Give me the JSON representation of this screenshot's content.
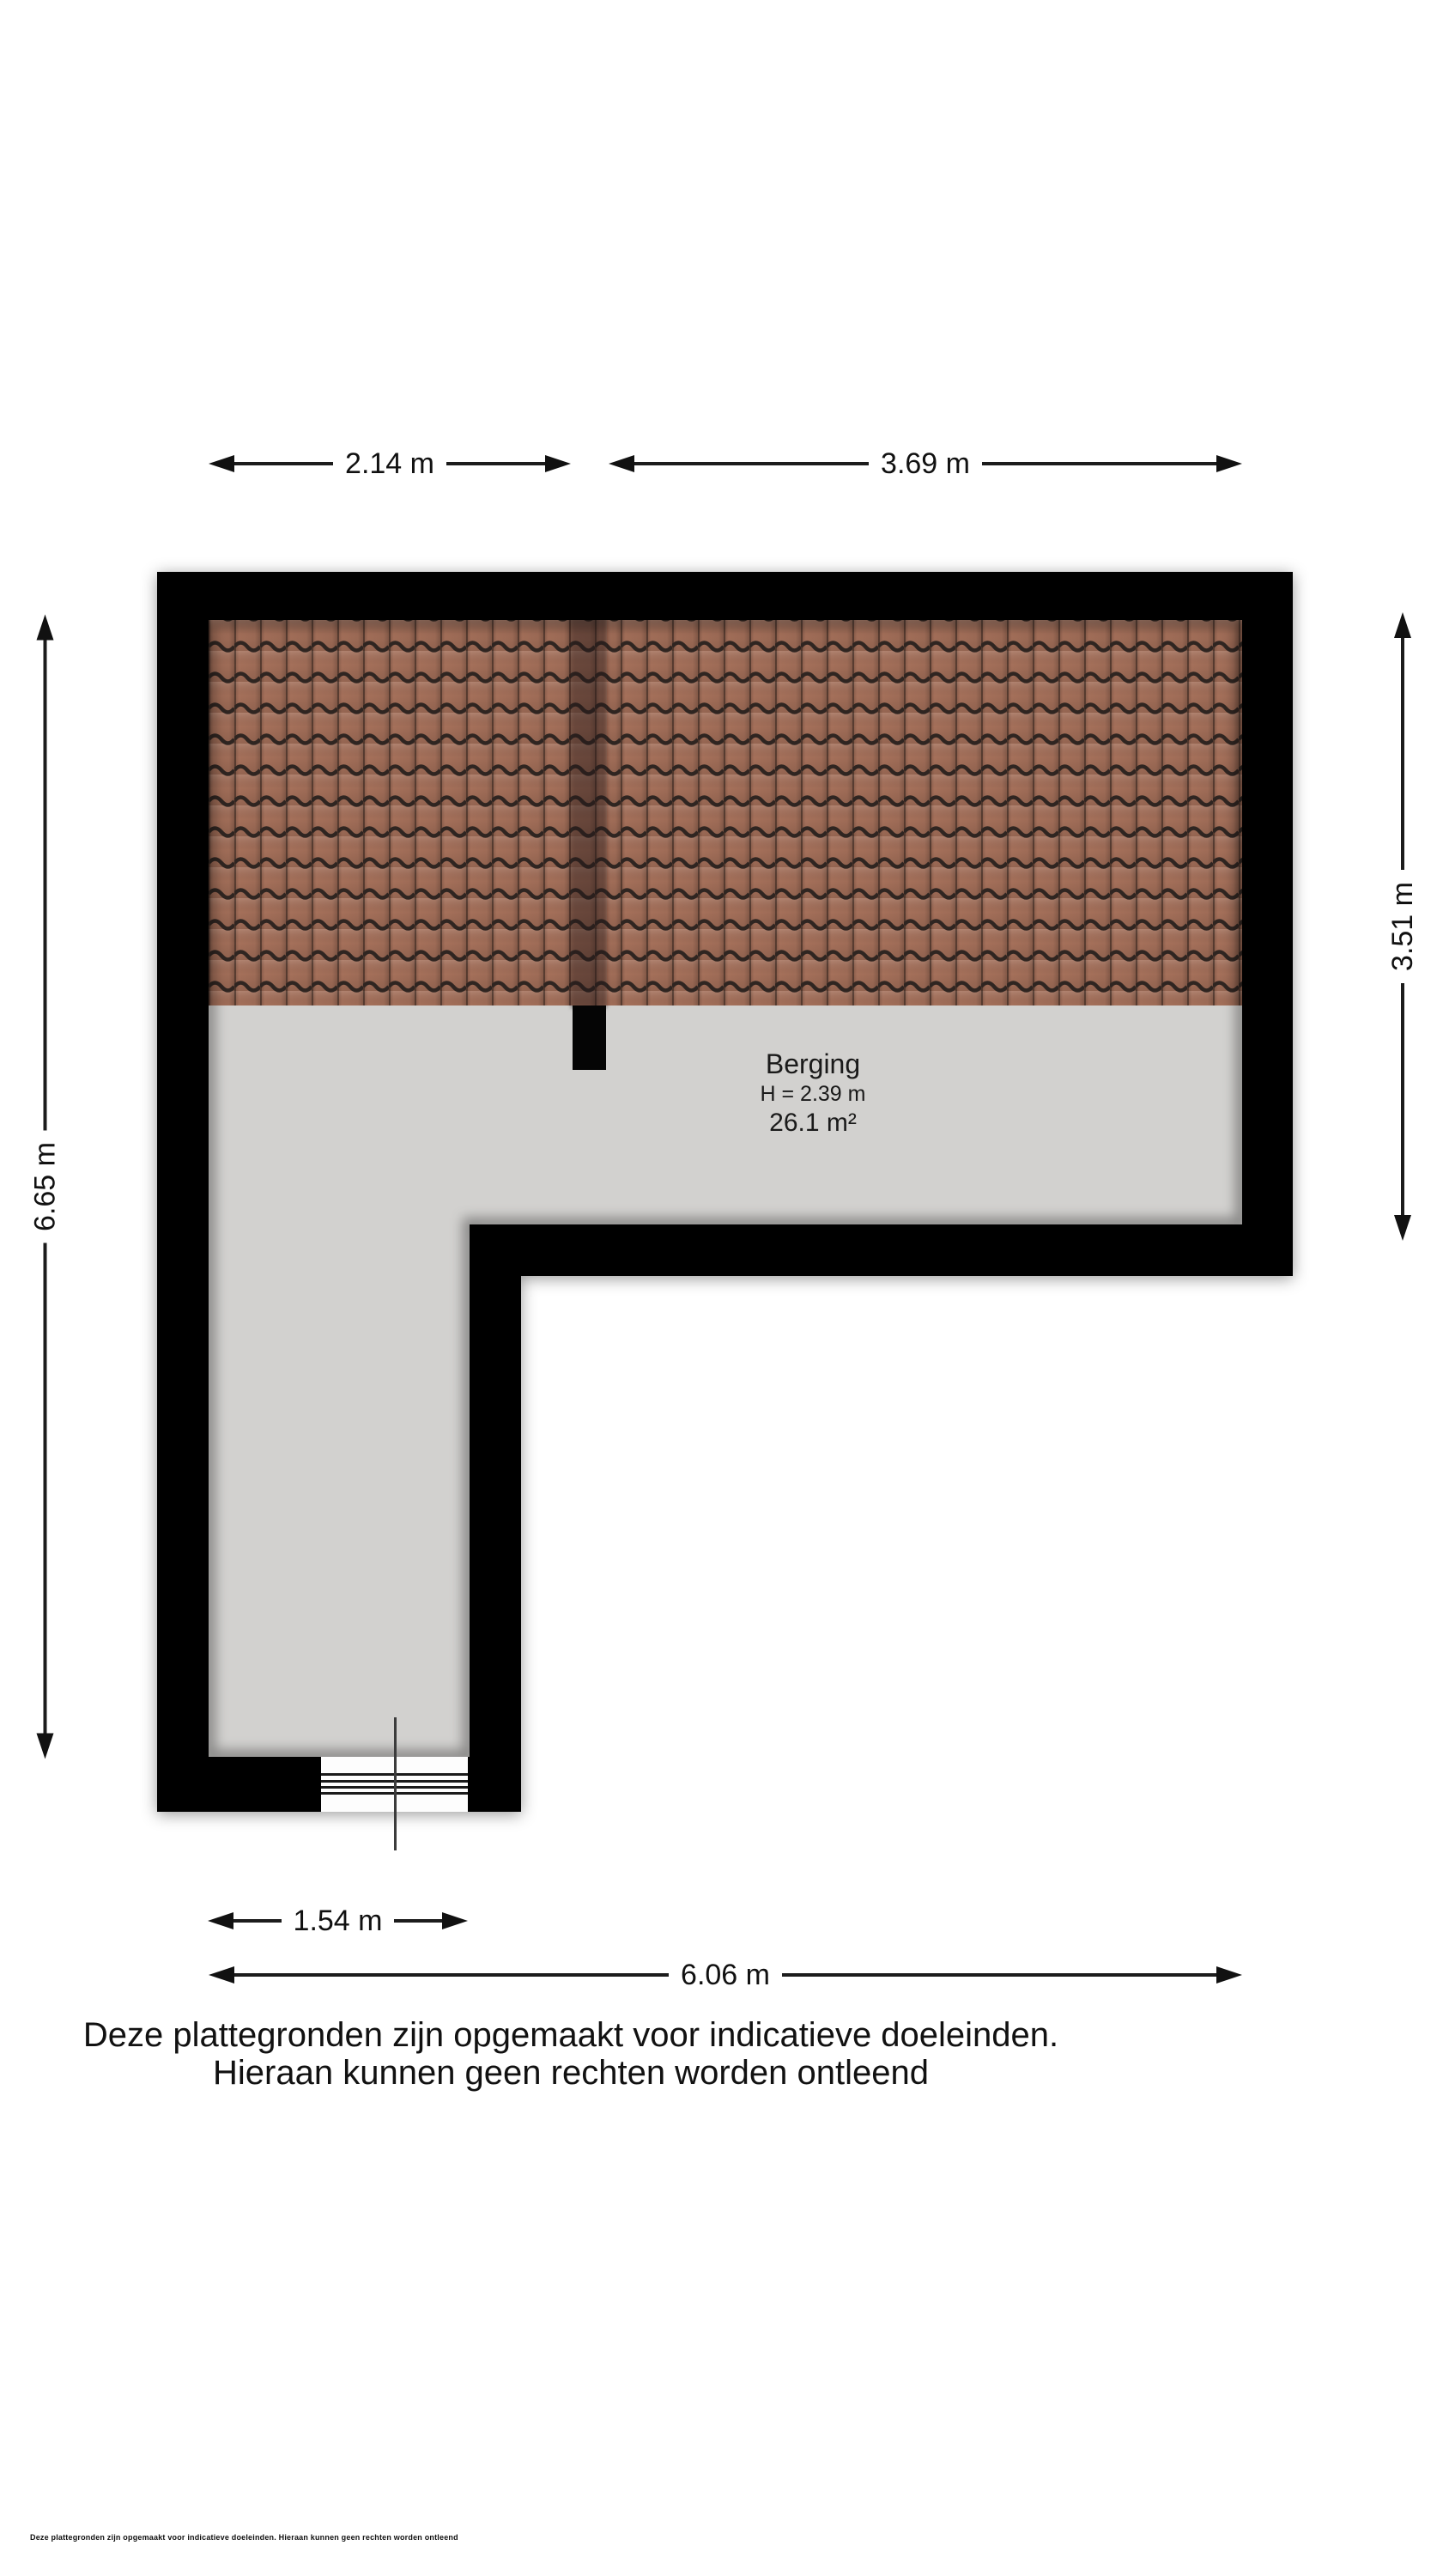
{
  "dims": {
    "top_left": "2.14 m",
    "top_right": "3.69 m",
    "left": "6.65 m",
    "right": "3.51 m",
    "bottom_inner": "1.54 m",
    "bottom_outer": "6.06 m"
  },
  "room": {
    "name": "Berging",
    "ceiling_height": "H = 2.39 m",
    "area": "26.1 m²"
  },
  "disclaimer": {
    "line1": "Deze plattegronden zijn opgemaakt voor indicatieve doeleinden.",
    "line2": "Hieraan kunnen geen rechten worden ontleend"
  },
  "fine_print": "Deze plattegronden zijn opgemaakt voor indicatieve doeleinden. Hieraan kunnen geen rechten worden ontleend",
  "colors": {
    "wall": "#050505",
    "floor": "#d2d1cf",
    "roof_tile": "#a5705a",
    "roof_tile_line": "#2f2521",
    "background": "#ffffff"
  }
}
